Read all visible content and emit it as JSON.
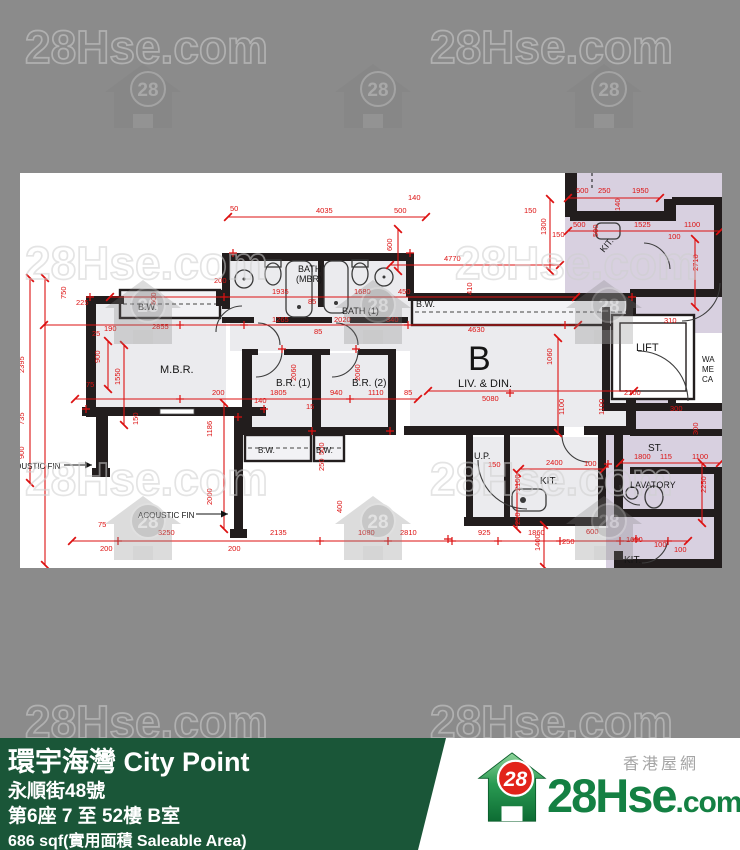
{
  "colors": {
    "bg": "#8b8b8b",
    "wall": "#221d1d",
    "dim_red": "#dd1111",
    "unit_fill": "#ebebee",
    "common_fill": "#d8d0e0",
    "footer_green": "#1a5638",
    "brand_green": "#148043",
    "brand_red": "#e2231a"
  },
  "watermark": {
    "text": "28Hse.com",
    "logo_number": "28"
  },
  "floorplan": {
    "unit_letter": "B",
    "labels": [
      [
        "B.W.",
        118,
        137,
        9,
        0
      ],
      [
        "M.B.R.",
        140,
        200,
        11,
        0
      ],
      [
        "BATH",
        278,
        99,
        9,
        0
      ],
      [
        "(MBR)",
        276,
        109,
        9,
        0
      ],
      [
        "BATH (1)",
        322,
        141,
        9,
        0
      ],
      [
        "B.R. (1)",
        256,
        213,
        10,
        0
      ],
      [
        "B.R. (2)",
        332,
        213,
        10,
        0
      ],
      [
        "B.W.",
        396,
        134,
        9,
        0
      ],
      [
        "B",
        448,
        197,
        34,
        0
      ],
      [
        "LIV. & DIN.",
        438,
        214,
        11,
        0
      ],
      [
        "B.W.",
        238,
        280,
        8,
        0
      ],
      [
        "B.W.",
        296,
        280,
        8,
        0
      ],
      [
        "U.P.",
        454,
        286,
        9,
        0
      ],
      [
        "KIT.",
        520,
        311,
        10,
        0
      ],
      [
        "KIT.",
        584,
        80,
        9,
        -50
      ],
      [
        "LIFT",
        616,
        178,
        11,
        0
      ],
      [
        "ST.",
        628,
        278,
        10,
        0
      ],
      [
        "LAVATORY",
        610,
        315,
        9,
        0
      ],
      [
        "KIT.",
        604,
        390,
        10,
        0
      ],
      [
        "ACOUSTIC FIN",
        -16,
        296,
        8,
        0
      ],
      [
        "ACOUSTIC FIN",
        118,
        345,
        8,
        0
      ],
      [
        "WA",
        682,
        189,
        8,
        0
      ],
      [
        "ME",
        682,
        199,
        8,
        0
      ],
      [
        "CA",
        682,
        209,
        8,
        0
      ]
    ],
    "dims": [
      [
        "50",
        210,
        38,
        0
      ],
      [
        "4035",
        296,
        40,
        0
      ],
      [
        "500",
        374,
        40,
        0
      ],
      [
        "140",
        388,
        27,
        0
      ],
      [
        "500",
        556,
        20,
        0
      ],
      [
        "250",
        578,
        20,
        0
      ],
      [
        "1950",
        612,
        20,
        0
      ],
      [
        "140",
        600,
        38,
        90
      ],
      [
        "500",
        553,
        54,
        0
      ],
      [
        "1525",
        614,
        54,
        0
      ],
      [
        "1100",
        664,
        54,
        0
      ],
      [
        "100",
        648,
        66,
        0
      ],
      [
        "150",
        532,
        64,
        0
      ],
      [
        "500",
        578,
        64,
        90
      ],
      [
        "2710",
        678,
        98,
        90
      ],
      [
        "1300",
        526,
        62,
        90
      ],
      [
        "150",
        504,
        40,
        0
      ],
      [
        "4770",
        424,
        88,
        0
      ],
      [
        "600",
        372,
        78,
        90
      ],
      [
        "410",
        452,
        122,
        90
      ],
      [
        "200",
        194,
        110,
        0
      ],
      [
        "1935",
        252,
        121,
        0
      ],
      [
        "85",
        288,
        131,
        0
      ],
      [
        "1680",
        334,
        121,
        0
      ],
      [
        "450",
        378,
        121,
        0
      ],
      [
        "750",
        46,
        126,
        90
      ],
      [
        "225",
        56,
        132,
        0
      ],
      [
        "500",
        136,
        132,
        90
      ],
      [
        "190",
        84,
        158,
        0
      ],
      [
        "2855",
        132,
        156,
        0
      ],
      [
        "25",
        72,
        163,
        0
      ],
      [
        "900",
        80,
        190,
        90
      ],
      [
        "2395",
        4,
        200,
        90
      ],
      [
        "1550",
        100,
        212,
        90
      ],
      [
        "75",
        66,
        214,
        0
      ],
      [
        "735",
        4,
        252,
        90
      ],
      [
        "900",
        4,
        286,
        90
      ],
      [
        "150",
        118,
        252,
        90
      ],
      [
        "1186",
        192,
        264,
        90
      ],
      [
        "2000",
        192,
        332,
        90
      ],
      [
        "1265",
        252,
        149,
        0
      ],
      [
        "2020",
        314,
        149,
        0
      ],
      [
        "85",
        294,
        161,
        0
      ],
      [
        "200",
        192,
        222,
        0
      ],
      [
        "140",
        234,
        230,
        0
      ],
      [
        "1805",
        250,
        222,
        0
      ],
      [
        "940",
        310,
        222,
        0
      ],
      [
        "1110",
        348,
        222,
        0
      ],
      [
        "85",
        384,
        222,
        0
      ],
      [
        "15",
        286,
        236,
        0
      ],
      [
        "2060",
        276,
        208,
        90
      ],
      [
        "2060",
        340,
        208,
        90
      ],
      [
        "500",
        304,
        282,
        90
      ],
      [
        "250",
        304,
        298,
        90
      ],
      [
        "400",
        322,
        340,
        90
      ],
      [
        "340",
        366,
        149,
        0
      ],
      [
        "4630",
        448,
        159,
        0
      ],
      [
        "310",
        644,
        150,
        0
      ],
      [
        "5080",
        462,
        228,
        0
      ],
      [
        "1060",
        532,
        192,
        90
      ],
      [
        "1100",
        544,
        242,
        90
      ],
      [
        "1100",
        584,
        242,
        90
      ],
      [
        "2100",
        604,
        222,
        0
      ],
      [
        "300",
        650,
        238,
        0
      ],
      [
        "1800",
        614,
        286,
        0
      ],
      [
        "115",
        640,
        286,
        0
      ],
      [
        "1100",
        672,
        286,
        0
      ],
      [
        "300",
        678,
        262,
        90
      ],
      [
        "2250",
        686,
        320,
        90
      ],
      [
        "2400",
        526,
        292,
        0
      ],
      [
        "100",
        564,
        293,
        0
      ],
      [
        "150",
        468,
        294,
        0
      ],
      [
        "2100",
        500,
        318,
        90
      ],
      [
        "250",
        500,
        352,
        90
      ],
      [
        "75",
        78,
        354,
        0
      ],
      [
        "200",
        80,
        378,
        0
      ],
      [
        "3250",
        138,
        362,
        0
      ],
      [
        "2135",
        250,
        362,
        0
      ],
      [
        "1080",
        338,
        362,
        0
      ],
      [
        "2810",
        380,
        362,
        0
      ],
      [
        "925",
        458,
        362,
        0
      ],
      [
        "1860",
        508,
        362,
        0
      ],
      [
        "250",
        542,
        371,
        0
      ],
      [
        "600",
        566,
        361,
        0
      ],
      [
        "1650",
        606,
        369,
        0
      ],
      [
        "100",
        634,
        374,
        0
      ],
      [
        "100",
        654,
        379,
        0
      ],
      [
        "1400",
        520,
        378,
        90
      ],
      [
        "200",
        208,
        378,
        0
      ]
    ]
  },
  "footer": {
    "title": "環宇海灣 City Point",
    "address": "永順街48號",
    "unit": "第6座 7 至 52樓 B室",
    "area": "686 sqf(實用面積 Saleable Area)"
  },
  "logo": {
    "number": "28",
    "site": "28Hse",
    "tld": ".com",
    "site_cn": "香港屋網"
  }
}
